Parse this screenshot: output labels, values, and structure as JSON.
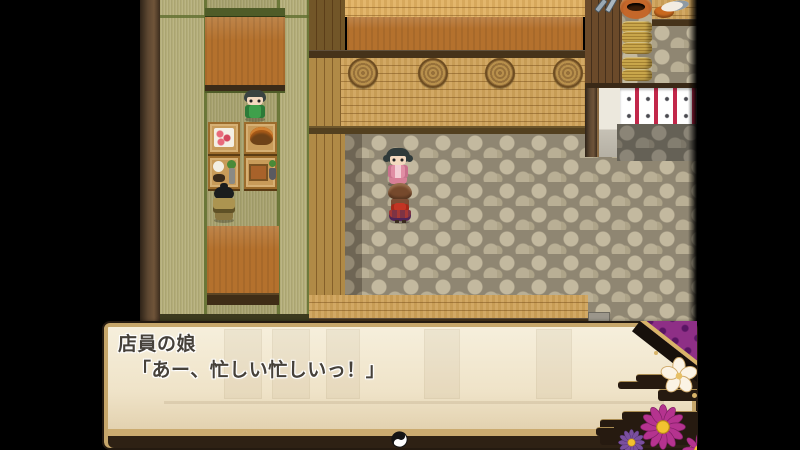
{
  "message_window": {
    "speaker": "店員の娘",
    "text": "「あー、忙しい忙しいっ！」",
    "pause_indicator": "yin-yang-icon"
  },
  "scene": {
    "npcs": [
      {
        "id": "clerk-girl-green",
        "desc": "clerk girl in green behind shelf"
      },
      {
        "id": "patron-topknot",
        "desc": "patron with topknot facing food stalls"
      },
      {
        "id": "girl-pink-kimono",
        "desc": "girl in pink kimono facing forward"
      },
      {
        "id": "girl-red-bow-back",
        "desc": "girl with red obi bow seen from behind"
      }
    ],
    "props": [
      "food-display-tables",
      "log-medallion-counter",
      "noren-curtain",
      "storage-baskets",
      "clay-pot",
      "fish-counter",
      "tatami-floor",
      "cobblestone-floor"
    ]
  },
  "palette": {
    "window_bg": "#f1e8d3",
    "window_frame_gold": "#c6a66a",
    "window_border_dark": "#241a10",
    "text_color": "#46413a",
    "fabric_purple": "#8e2f86",
    "flower_magenta": "#b5338f",
    "flower_violet": "#7a4f9e",
    "flower_center_gold": "#f2c230",
    "noren_red": "#c2274a",
    "tatami_green": "#5f6e2e",
    "counter_top": "#b4712d",
    "wood_light": "#cfa258",
    "letterbox": "#000000"
  }
}
